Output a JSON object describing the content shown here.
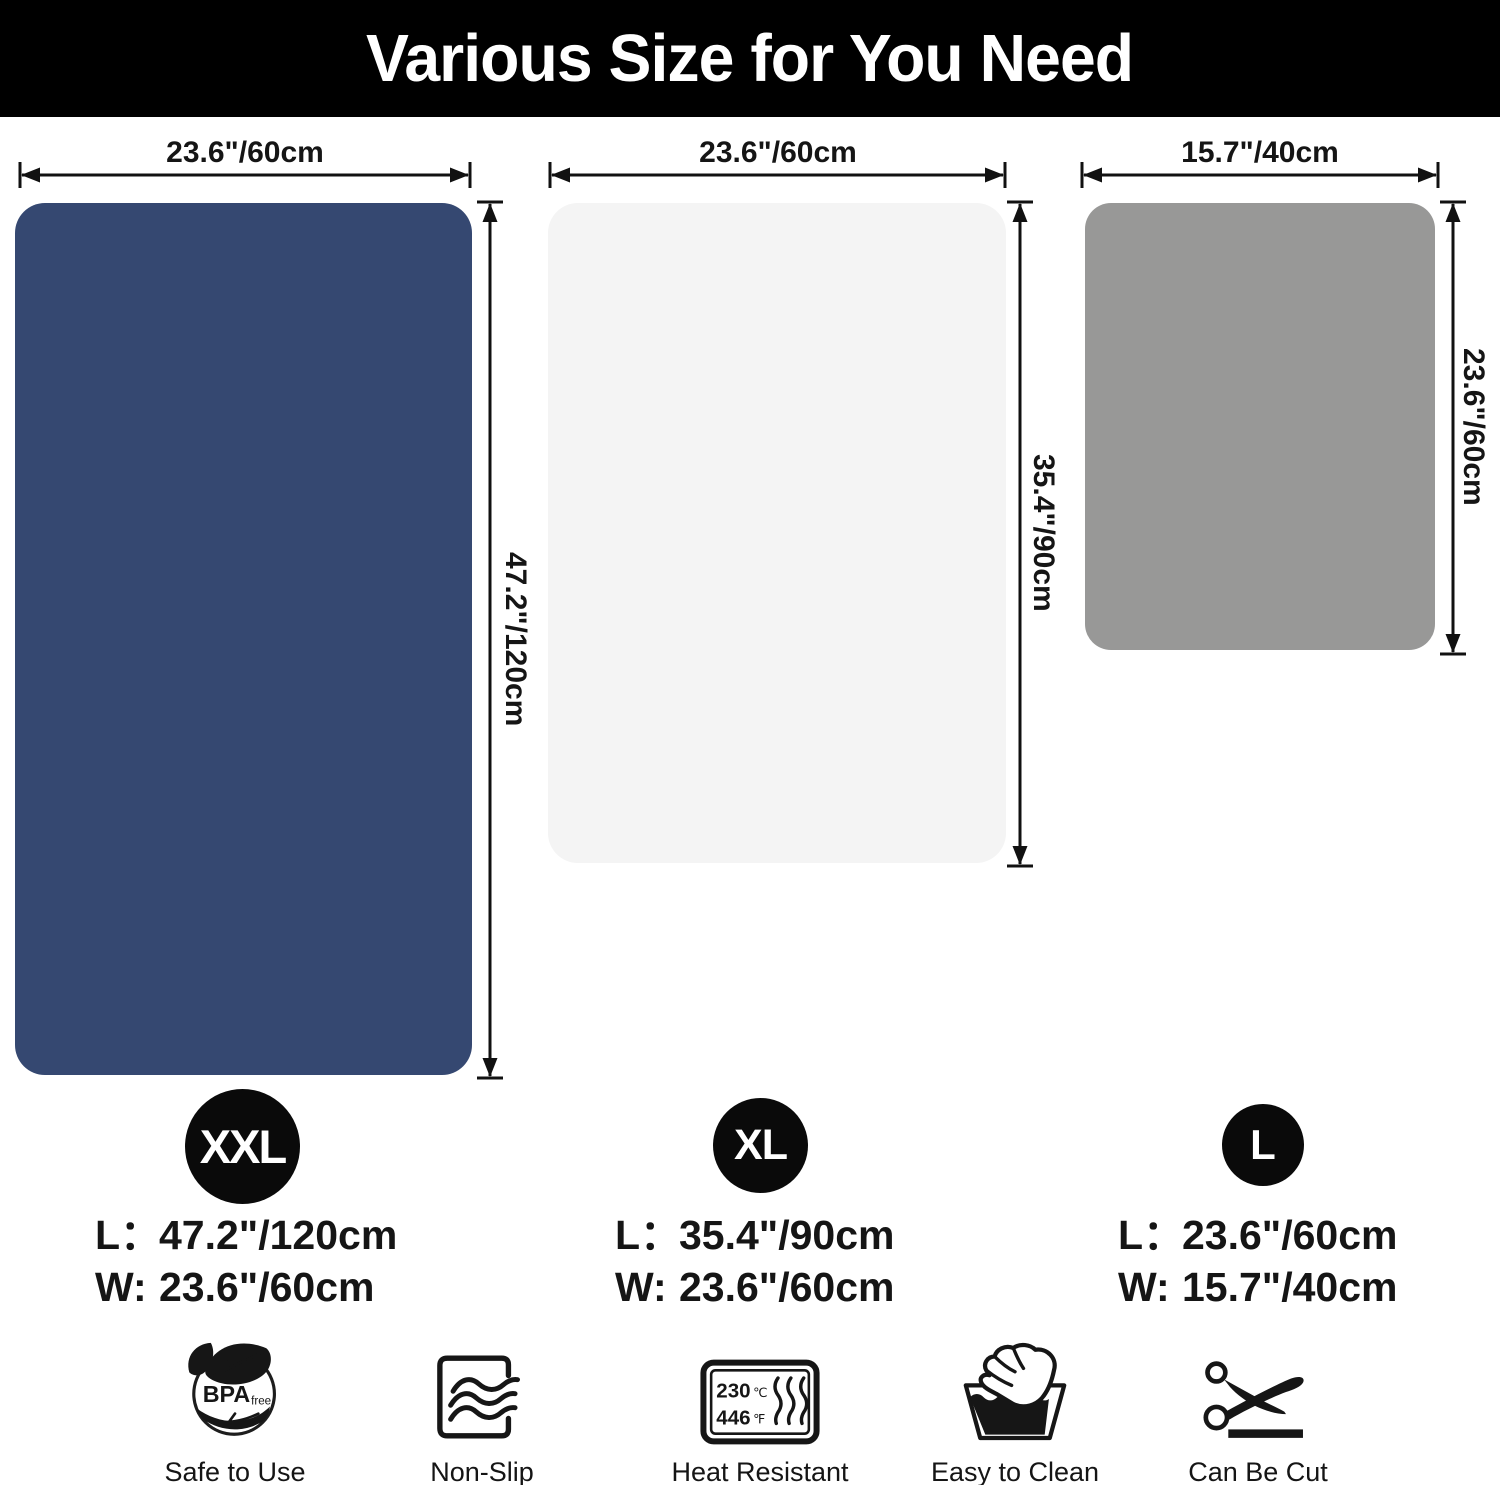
{
  "header": {
    "title": "Various Size for You Need"
  },
  "colors": {
    "header_bg": "#000000",
    "header_text": "#ffffff",
    "mat_xxl": "#354871",
    "mat_xl": "#f4f4f4",
    "mat_l": "#989897",
    "badge_bg": "#0a0a0a",
    "ink": "#151515"
  },
  "mats": [
    {
      "badge": "XXL",
      "width_label": "23.6\"/60cm",
      "height_label": "47.2\"/120cm",
      "specs": [
        {
          "label": "L：",
          "value": "47.2\"/120cm"
        },
        {
          "label": "W:",
          "value": "23.6\"/60cm"
        }
      ]
    },
    {
      "badge": "XL",
      "width_label": "23.6\"/60cm",
      "height_label": "35.4\"/90cm",
      "specs": [
        {
          "label": "L：",
          "value": "35.4\"/90cm"
        },
        {
          "label": "W:",
          "value": "23.6\"/60cm"
        }
      ]
    },
    {
      "badge": "L",
      "width_label": "15.7\"/40cm",
      "height_label": "23.6\"/60cm",
      "specs": [
        {
          "label": "L：",
          "value": "23.6\"/60cm"
        },
        {
          "label": "W:",
          "value": "15.7\"/40cm"
        }
      ]
    }
  ],
  "features": [
    {
      "icon": "bpa-free-icon",
      "label": "Safe to Use",
      "icon_text_main": "BPA",
      "icon_text_sub": "free"
    },
    {
      "icon": "non-slip-icon",
      "label": "Non-Slip"
    },
    {
      "icon": "heat-resistant-icon",
      "label": "Heat Resistant",
      "temp_c": "230",
      "temp_c_unit": "℃",
      "temp_f": "446",
      "temp_f_unit": "℉"
    },
    {
      "icon": "easy-to-clean-icon",
      "label": "Easy to Clean"
    },
    {
      "icon": "can-be-cut-icon",
      "label": "Can Be Cut"
    }
  ]
}
